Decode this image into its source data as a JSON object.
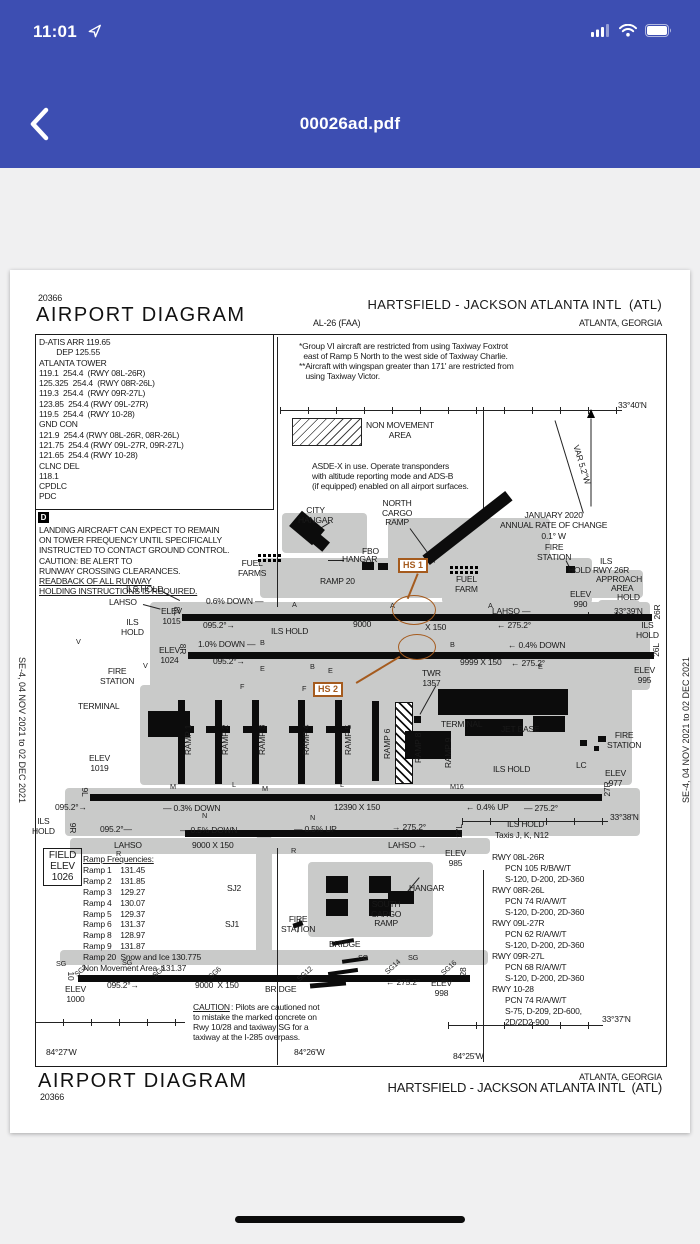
{
  "status_bar": {
    "time": "11:01"
  },
  "nav_bar": {
    "title": "00026ad.pdf"
  },
  "document": {
    "header": {
      "chart_number_top": "20366",
      "title_left": "AIRPORT DIAGRAM",
      "airport_title": "HARTSFIELD - JACKSON ATLANTA INTL  (ATL)",
      "procedure_id": "AL-26 (FAA)",
      "city_state": "ATLANTA, GEORGIA"
    },
    "comm_box": {
      "lines": [
        "D-ATIS ARR 119.65",
        "        DEP 125.55",
        "ATLANTA TOWER",
        "119.1  254.4  (RWY 08L-26R)",
        "125.325  254.4  (RWY 08R-26L)",
        "119.3  254.4  (RWY 09R-27L)",
        "123.85  254.4 (RWY 09L-27R)",
        "119.5  254.4  (RWY 10-28)",
        "GND CON",
        "121.9  254.4 (RWY 08L-26R, 08R-26L)",
        "121.75  254.4 (RWY 09L-27R, 09R-27L)",
        "121.65  254.4 (RWY 10-28)",
        "CLNC DEL",
        "118.1",
        "CPDLC",
        "PDC"
      ]
    },
    "landing_note": {
      "icon": "D",
      "lines": [
        "LANDING AIRCRAFT CAN EXPECT TO REMAIN",
        "ON TOWER FREQUENCY UNTIL SPECIFICALLY",
        "INSTRUCTED TO CONTACT GROUND CONTROL.",
        "CAUTION: BE ALERT TO",
        "RUNWAY CROSSING CLEARANCES.",
        "READBACK OF ALL RUNWAY",
        "HOLDING INSTRUCTIONS IS REQUIRED."
      ]
    },
    "notes": {
      "group_vi": "*Group VI aircraft are restricted from using Taxiway Foxtrot\n  east of Ramp 5 North to the west side of Taxiway Charlie.\n**Aircraft with wingspan greater than 171' are restricted from\n   using Taxiway Victor.",
      "non_movement": "NON MOVEMENT\nAREA",
      "asde": "ASDE-X in use. Operate transponders\nwith altitude reporting mode and ADS-B\n(if equipped) enabled on all airport surfaces.",
      "annual_change": "JANUARY 2020\nANNUAL RATE OF CHANGE\n0.1° W"
    },
    "field_elev": {
      "lines": [
        "FIELD",
        "ELEV",
        "1026"
      ]
    },
    "ramp_frequencies": {
      "lines": [
        "Ramp Frequencies:",
        "Ramp 1    131.45",
        "Ramp 2    131.85",
        "Ramp 3    129.27",
        "Ramp 4    130.07",
        "Ramp 5    129.37",
        "Ramp 6    131.37",
        "Ramp 8    128.97",
        "Ramp 9    131.87",
        "Ramp 20  Snow and Ice 130.775",
        "Non Movement Area  131.37"
      ]
    },
    "runway_data": {
      "lines": [
        "RWY 08L-26R",
        "      PCN 105 R/B/W/T",
        "      S-120, D-200, 2D-360",
        "RWY 08R-26L",
        "      PCN 74 R/A/W/T",
        "      S-120, D-200, 2D-360",
        "RWY 09L-27R",
        "      PCN 62 R/A/W/T",
        "      S-120, D-200, 2D-360",
        "RWY 09R-27L",
        "      PCN 68 R/A/W/T",
        "      S-120, D-200, 2D-360",
        "RWY 10-28",
        "      PCN 74 R/A/W/T",
        "      S-75, D-209, 2D-600,",
        "      2D/2D2-900"
      ]
    },
    "footer": {
      "title": "AIRPORT DIAGRAM",
      "chart_number": "20366",
      "city_state": "ATLANTA, GEORGIA",
      "airport_title": "HARTSFIELD - JACKSON ATLANTA INTL  (ATL)"
    },
    "side_text": "SE-4,  04 NOV 2021  to  02 DEC 2021",
    "hotspots": [
      {
        "label": "HS 1",
        "x": 388,
        "y": 288
      },
      {
        "label": "HS 2",
        "x": 303,
        "y": 412
      }
    ],
    "labels": [
      {
        "t": "CITY\nHANGAR",
        "x": 288,
        "y": 236,
        "c": "c"
      },
      {
        "t": "NORTH\nCARGO\nRAMP",
        "x": 372,
        "y": 229,
        "c": "c"
      },
      {
        "t": "HANGAR",
        "x": 332,
        "y": 285
      },
      {
        "t": "FBO",
        "x": 352,
        "y": 277
      },
      {
        "t": "FUEL\nFARMS",
        "x": 228,
        "y": 289,
        "c": "c"
      },
      {
        "t": "RAMP 20",
        "x": 310,
        "y": 307
      },
      {
        "t": "FUEL\nFARM",
        "x": 445,
        "y": 305,
        "c": "c"
      },
      {
        "t": "FIRE\nSTATION",
        "x": 527,
        "y": 273,
        "c": "c"
      },
      {
        "t": "ILS",
        "x": 590,
        "y": 287
      },
      {
        "t": "HOLD RWY 26R",
        "x": 558,
        "y": 296
      },
      {
        "t": "APPROACH",
        "x": 586,
        "y": 305
      },
      {
        "t": "AREA",
        "x": 601,
        "y": 314
      },
      {
        "t": "HOLD",
        "x": 607,
        "y": 323
      },
      {
        "t": "ELEV\n990",
        "x": 560,
        "y": 320,
        "c": "c"
      },
      {
        "t": "33°39'N",
        "x": 604,
        "y": 337
      },
      {
        "t": "33°40'N",
        "x": 608,
        "y": 131
      },
      {
        "t": "33°38'N",
        "x": 600,
        "y": 543
      },
      {
        "t": "33°37'N",
        "x": 592,
        "y": 745
      },
      {
        "t": "VAR 5.2°W",
        "x": 551,
        "y": 190,
        "c": "var"
      },
      {
        "t": "ILS HOLD",
        "x": 116,
        "y": 315
      },
      {
        "t": "LAHSO",
        "x": 99,
        "y": 328
      },
      {
        "t": "ELEV\n1015",
        "x": 151,
        "y": 337,
        "c": "c"
      },
      {
        "t": "ILS\nHOLD",
        "x": 111,
        "y": 348,
        "c": "c"
      },
      {
        "t": "0.6% DOWN —",
        "x": 196,
        "y": 327
      },
      {
        "t": "095.2°→",
        "x": 193,
        "y": 351
      },
      {
        "t": "ILS HOLD",
        "x": 261,
        "y": 357
      },
      {
        "t": "9000",
        "x": 343,
        "y": 350
      },
      {
        "t": "X 150",
        "x": 415,
        "y": 353
      },
      {
        "t": "LAHSO —",
        "x": 482,
        "y": 337
      },
      {
        "t": "← 275.2°",
        "x": 487,
        "y": 351
      },
      {
        "t": "ILS\nHOLD",
        "x": 626,
        "y": 351,
        "c": "c"
      },
      {
        "t": "1.0% DOWN —",
        "x": 188,
        "y": 370
      },
      {
        "t": "095.2°→",
        "x": 203,
        "y": 387
      },
      {
        "t": "9999 X 150",
        "x": 450,
        "y": 388
      },
      {
        "t": "← 0.4% DOWN",
        "x": 498,
        "y": 371
      },
      {
        "t": "← 275.2°",
        "x": 501,
        "y": 389
      },
      {
        "t": "ELEV\n1024",
        "x": 149,
        "y": 376,
        "c": "c"
      },
      {
        "t": "ELEV\n995",
        "x": 624,
        "y": 396,
        "c": "c"
      },
      {
        "t": "FIRE\nSTATION",
        "x": 90,
        "y": 397,
        "c": "c"
      },
      {
        "t": "TERMINAL",
        "x": 68,
        "y": 432
      },
      {
        "t": "TWR\n1357",
        "x": 412,
        "y": 399,
        "c": "c"
      },
      {
        "t": "TERMINAL",
        "x": 431,
        "y": 450
      },
      {
        "t": "JET BASE",
        "x": 491,
        "y": 455
      },
      {
        "t": "FIRE\nSTATION",
        "x": 597,
        "y": 461,
        "c": "c"
      },
      {
        "t": "LC",
        "x": 566,
        "y": 491
      },
      {
        "t": "ELEV\n977",
        "x": 595,
        "y": 499,
        "c": "c"
      },
      {
        "t": "ILS HOLD",
        "x": 483,
        "y": 495
      },
      {
        "t": "ELEV\n1019",
        "x": 79,
        "y": 484,
        "c": "c"
      },
      {
        "t": "RAMP 1",
        "x": 179,
        "y": 470,
        "c": "rot"
      },
      {
        "t": "RAMP 2",
        "x": 216,
        "y": 470,
        "c": "rot"
      },
      {
        "t": "RAMP 3",
        "x": 253,
        "y": 470,
        "c": "rot"
      },
      {
        "t": "RAMP 4",
        "x": 297,
        "y": 470,
        "c": "rot"
      },
      {
        "t": "RAMP 5",
        "x": 339,
        "y": 470,
        "c": "rot"
      },
      {
        "t": "RAMP 6",
        "x": 378,
        "y": 474,
        "c": "rot"
      },
      {
        "t": "RAMP 8",
        "x": 409,
        "y": 478,
        "c": "rot"
      },
      {
        "t": "RAMP 9",
        "x": 439,
        "y": 483,
        "c": "rot"
      },
      {
        "t": "095.2°→",
        "x": 45,
        "y": 533
      },
      {
        "t": "— 0.3% DOWN",
        "x": 153,
        "y": 534
      },
      {
        "t": "12390 X 150",
        "x": 324,
        "y": 533
      },
      {
        "t": "← 0.4% UP",
        "x": 456,
        "y": 533
      },
      {
        "t": "— 275.2°",
        "x": 514,
        "y": 534
      },
      {
        "t": "M16",
        "x": 440,
        "y": 513,
        "c": "sm"
      },
      {
        "t": "ILS\nHOLD",
        "x": 22,
        "y": 547,
        "c": "c"
      },
      {
        "t": "095.2°—",
        "x": 90,
        "y": 555
      },
      {
        "t": "— 0.5% DOWN",
        "x": 170,
        "y": 556
      },
      {
        "t": "— 0.5% UP",
        "x": 284,
        "y": 555
      },
      {
        "t": "→ 275.2°",
        "x": 382,
        "y": 553
      },
      {
        "t": "ILS HOLD",
        "x": 497,
        "y": 550
      },
      {
        "t": "Taxis J, K, N12",
        "x": 485,
        "y": 561
      },
      {
        "t": "LAHSO",
        "x": 104,
        "y": 571
      },
      {
        "t": "9000 X 150",
        "x": 182,
        "y": 571
      },
      {
        "t": "LAHSO →",
        "x": 378,
        "y": 571
      },
      {
        "t": "ELEV\n985",
        "x": 435,
        "y": 579,
        "c": "c"
      },
      {
        "t": "SJ2",
        "x": 217,
        "y": 614
      },
      {
        "t": "SJ1",
        "x": 215,
        "y": 650
      },
      {
        "t": "FIRE\nSTATION",
        "x": 271,
        "y": 645,
        "c": "c"
      },
      {
        "t": "HANGAR",
        "x": 399,
        "y": 614
      },
      {
        "t": "SOUTH\nCARGO\nRAMP",
        "x": 361,
        "y": 630,
        "c": "c"
      },
      {
        "t": "BRIDGE",
        "x": 319,
        "y": 670
      },
      {
        "t": "BRIDGE",
        "x": 255,
        "y": 715
      },
      {
        "t": "SG",
        "x": 46,
        "y": 690,
        "c": "sm"
      },
      {
        "t": "SG2",
        "x": 64,
        "y": 697,
        "c": "smd"
      },
      {
        "t": "SG",
        "x": 112,
        "y": 689,
        "c": "sm"
      },
      {
        "t": "SG4",
        "x": 142,
        "y": 698,
        "c": "smd"
      },
      {
        "t": "SG6",
        "x": 198,
        "y": 699,
        "c": "smd"
      },
      {
        "t": "SG12",
        "x": 286,
        "y": 700,
        "c": "smd"
      },
      {
        "t": "SG",
        "x": 348,
        "y": 684,
        "c": "sm"
      },
      {
        "t": "SG14",
        "x": 374,
        "y": 693,
        "c": "smd"
      },
      {
        "t": "SG",
        "x": 398,
        "y": 684,
        "c": "sm"
      },
      {
        "t": "SG16",
        "x": 430,
        "y": 694,
        "c": "smd"
      },
      {
        "t": "10",
        "x": 60,
        "y": 706,
        "c": "rotl"
      },
      {
        "t": "28",
        "x": 454,
        "y": 702,
        "c": "rotr"
      },
      {
        "t": "8L",
        "x": 166,
        "y": 341,
        "c": "rotl"
      },
      {
        "t": "26R",
        "x": 648,
        "y": 342,
        "c": "rotr"
      },
      {
        "t": "8R",
        "x": 172,
        "y": 379,
        "c": "rotl"
      },
      {
        "t": "26L",
        "x": 647,
        "y": 380,
        "c": "rotr"
      },
      {
        "t": "9L",
        "x": 74,
        "y": 522,
        "c": "rotl"
      },
      {
        "t": "27R",
        "x": 598,
        "y": 519,
        "c": "rotr"
      },
      {
        "t": "9R",
        "x": 62,
        "y": 558,
        "c": "rotl"
      },
      {
        "t": "27L",
        "x": 450,
        "y": 561,
        "c": "rotr"
      },
      {
        "t": "ELEV\n1000",
        "x": 55,
        "y": 715,
        "c": "c"
      },
      {
        "t": "095.2°→",
        "x": 97,
        "y": 711
      },
      {
        "t": "9000  X 150",
        "x": 185,
        "y": 711
      },
      {
        "t": "← 275.2°",
        "x": 376,
        "y": 708
      },
      {
        "t": "ELEV\n998",
        "x": 421,
        "y": 709,
        "c": "c"
      },
      {
        "t": "CAUTION",
        "x": 183,
        "y": 733,
        "c": "u"
      },
      {
        "t": ": Pilots are cautioned not",
        "x": 221,
        "y": 733
      },
      {
        "t": "to mistake the marked concrete on",
        "x": 183,
        "y": 743
      },
      {
        "t": "Rwy 10/28 and taxiway SG for a",
        "x": 183,
        "y": 753
      },
      {
        "t": "taxiway at the I-285 overpass.",
        "x": 183,
        "y": 763
      },
      {
        "t": "84°27'W",
        "x": 36,
        "y": 778
      },
      {
        "t": "84°26'W",
        "x": 284,
        "y": 778
      },
      {
        "t": "84°25'W",
        "x": 443,
        "y": 782
      },
      {
        "t": "A",
        "x": 282,
        "y": 331,
        "c": "sm"
      },
      {
        "t": "A",
        "x": 380,
        "y": 332,
        "c": "sm"
      },
      {
        "t": "A",
        "x": 478,
        "y": 332,
        "c": "sm"
      },
      {
        "t": "B",
        "x": 250,
        "y": 369,
        "c": "sm"
      },
      {
        "t": "B",
        "x": 300,
        "y": 393,
        "c": "sm"
      },
      {
        "t": "B",
        "x": 440,
        "y": 371,
        "c": "sm"
      },
      {
        "t": "E",
        "x": 250,
        "y": 395,
        "c": "sm"
      },
      {
        "t": "E",
        "x": 318,
        "y": 397,
        "c": "sm"
      },
      {
        "t": "E",
        "x": 528,
        "y": 393,
        "c": "sm"
      },
      {
        "t": "F",
        "x": 230,
        "y": 413,
        "c": "sm"
      },
      {
        "t": "F",
        "x": 292,
        "y": 415,
        "c": "sm"
      },
      {
        "t": "V",
        "x": 66,
        "y": 368,
        "c": "sm"
      },
      {
        "t": "V",
        "x": 133,
        "y": 392,
        "c": "sm"
      },
      {
        "t": "M",
        "x": 160,
        "y": 513,
        "c": "sm"
      },
      {
        "t": "M",
        "x": 252,
        "y": 515,
        "c": "sm"
      },
      {
        "t": "N",
        "x": 192,
        "y": 542,
        "c": "sm"
      },
      {
        "t": "N",
        "x": 300,
        "y": 544,
        "c": "sm"
      },
      {
        "t": "L",
        "x": 222,
        "y": 511,
        "c": "sm"
      },
      {
        "t": "L",
        "x": 330,
        "y": 511,
        "c": "sm"
      },
      {
        "t": "R",
        "x": 106,
        "y": 580,
        "c": "sm"
      },
      {
        "t": "R",
        "x": 281,
        "y": 577,
        "c": "sm"
      }
    ]
  }
}
